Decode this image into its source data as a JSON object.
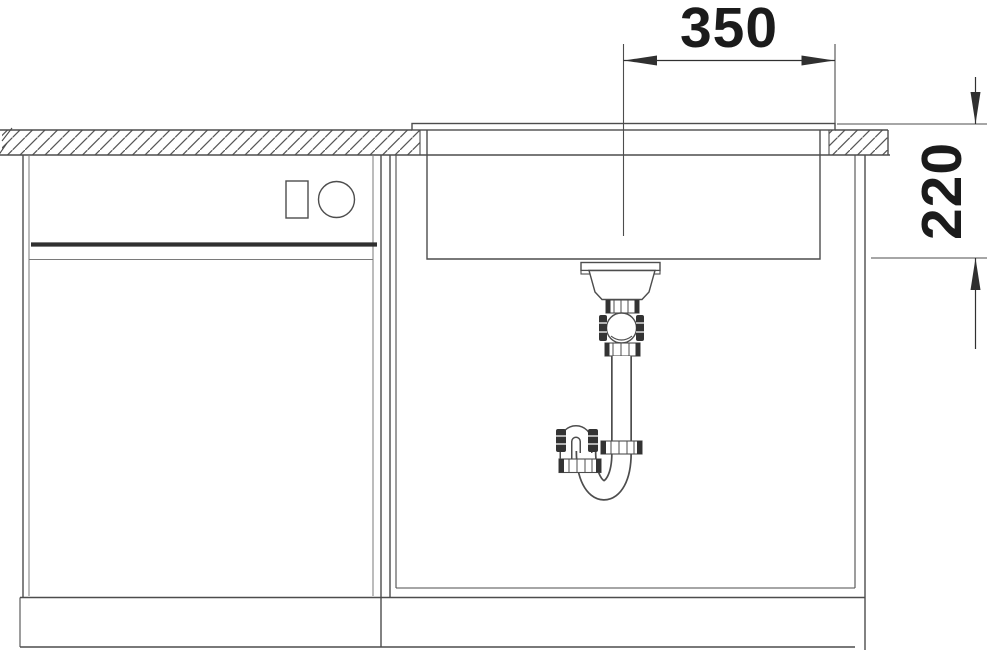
{
  "drawing": {
    "type": "technical-installation-drawing",
    "dimensions": {
      "bowl_offset": {
        "value": "350"
      },
      "bowl_depth": {
        "value": "220"
      }
    },
    "colors": {
      "background": "#ffffff",
      "line": "#4d4d4d",
      "line_dark": "#303030",
      "dim_text": "#1b1b1b",
      "fitting_dark": "#333333"
    }
  }
}
